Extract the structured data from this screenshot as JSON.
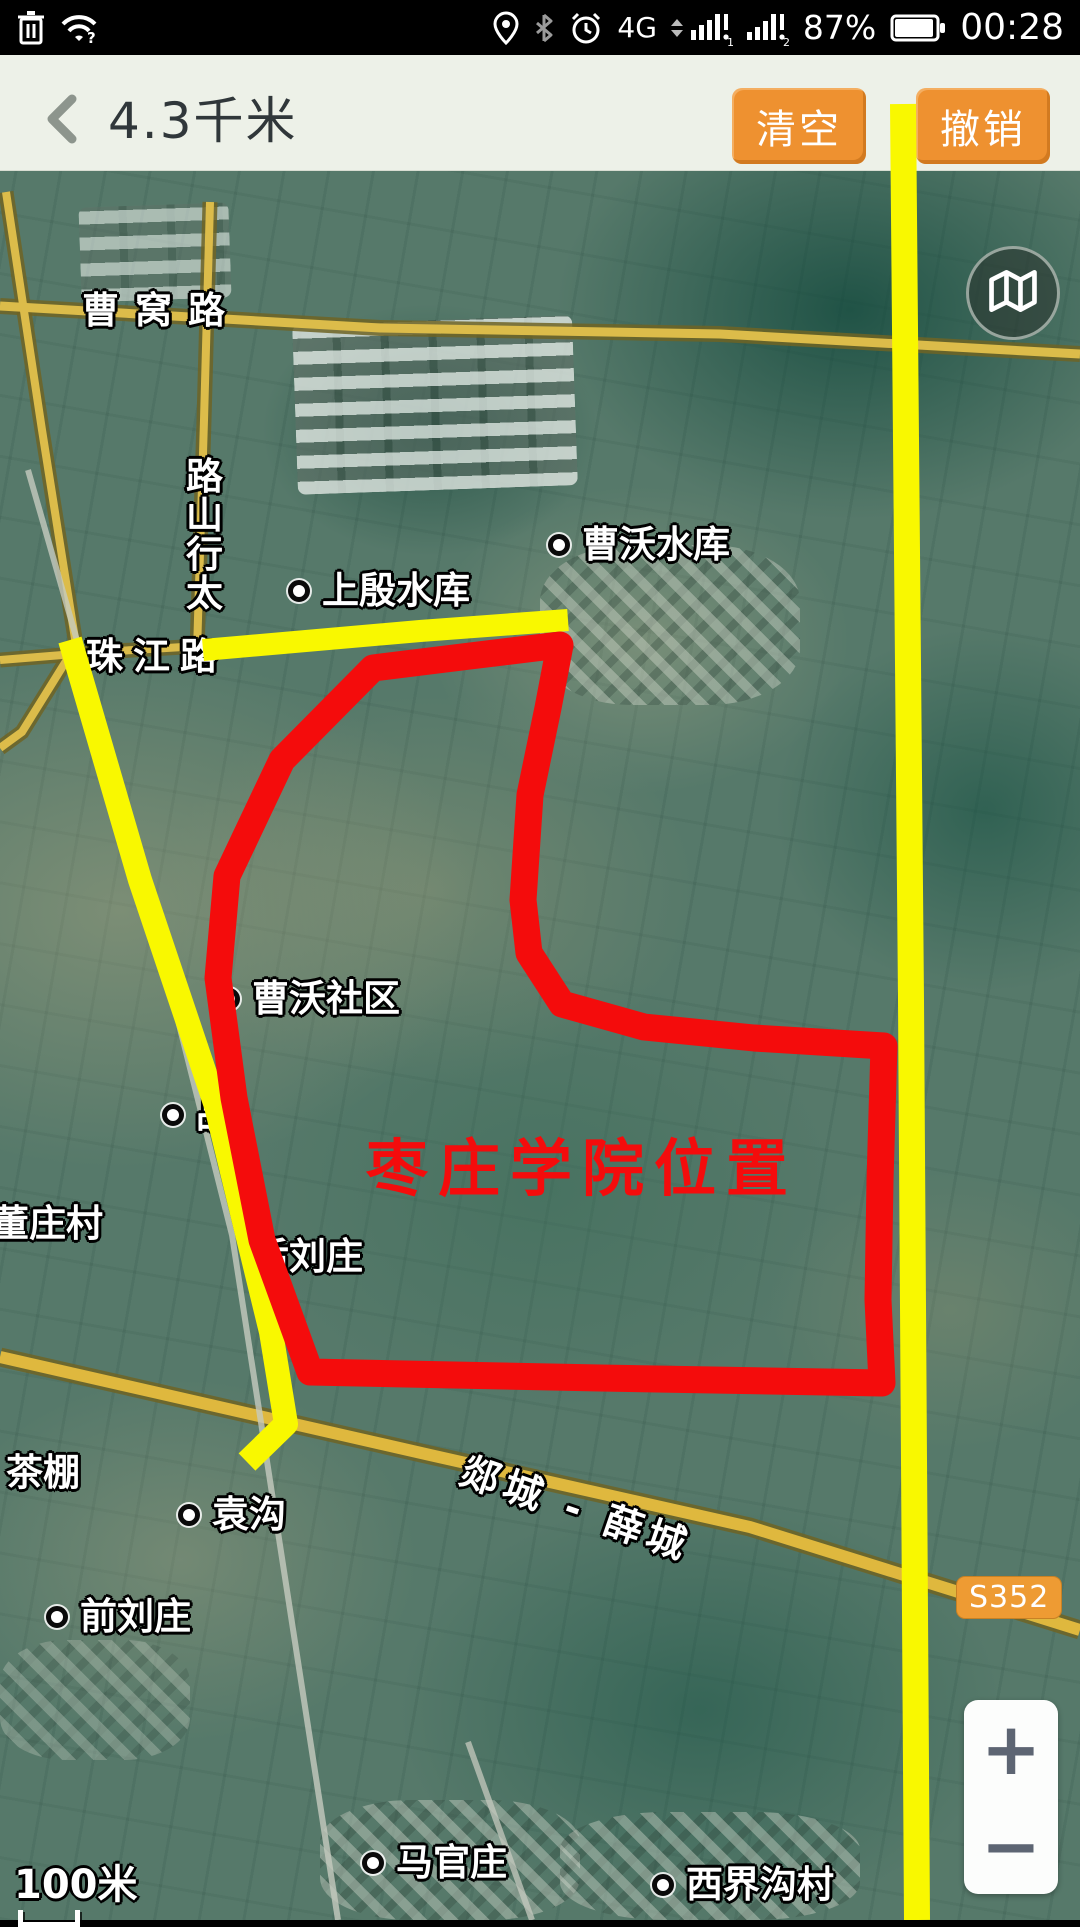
{
  "status_bar": {
    "network": "4G",
    "sim1_badge": "1",
    "sim2_badge": "2",
    "signal_alert": "!",
    "wifi_alert": "?",
    "battery_percent": "87%",
    "time": "00:28"
  },
  "header": {
    "title": "4.3千米",
    "clear_button": "清空",
    "undo_button": "撤销"
  },
  "map": {
    "labels": [
      {
        "name": "caowo-road-label",
        "text": "曹窝路"
      },
      {
        "name": "taihangshan-road-label",
        "road_name": "太行山路",
        "text": "路山行太"
      },
      {
        "name": "caowo-reservoir-label",
        "text": "曹沃水库"
      },
      {
        "name": "shangyin-reservoir-label",
        "text": "上殷水库"
      },
      {
        "name": "zhujiang-road-label",
        "text": "珠江路"
      },
      {
        "name": "caowo-community-label",
        "text": "曹沃社区"
      },
      {
        "name": "partial-village-label",
        "text": "品"
      },
      {
        "name": "dongzhuang-village-label",
        "text": "董庄村"
      },
      {
        "name": "houliuzhuang-label",
        "text": "后刘庄"
      },
      {
        "name": "chapeng-label",
        "text": "茶棚"
      },
      {
        "name": "yuangou-label",
        "text": "袁沟"
      },
      {
        "name": "qianliuzhuang-label",
        "text": "前刘庄"
      },
      {
        "name": "tancheng-xuecheng-road-label",
        "text": "郯城 - 薛城"
      },
      {
        "name": "maguanzhuang-label",
        "text": "马官庄"
      },
      {
        "name": "xijiegou-village-label",
        "text": "西界沟村"
      }
    ],
    "route_badge": "S352",
    "scale_text": "100米",
    "zoom_in": "+",
    "zoom_out": "−",
    "roads": {
      "caowo": "0,306 380,328 720,334 1080,354",
      "left_edge": "6,192 42,430 76,645 22,732 0,748",
      "taihangshan": "210,202 204,420 197,652",
      "zhujiang_west": "0,660 100,652 200,646",
      "tancheng_xuecheng": "0,1357 430,1455 750,1527 1080,1630",
      "railway": "28,470 120,790 232,1235 338,1920",
      "branch": "468,1742 532,1920"
    },
    "road_color": "#dcbc4a"
  },
  "annotations": {
    "red_label": "枣庄学院位置",
    "red_color": "#f40c0c",
    "yellow_color": "#f9f800",
    "red_polygon_points": "373,668 470,656 560,645 548,708 530,795 523,900 529,953 562,1004 644,1027 754,1038 884,1046 880,1180 878,1300 882,1383 600,1378 310,1372 262,1240 234,1098 218,978 227,876 282,760",
    "yellow_left_points": "70,640 140,880 216,1106 271,1332 286,1424 247,1462",
    "yellow_top_points": "203,650 420,631 568,620",
    "yellow_right_points": "903,104 911,1000 917,1920"
  }
}
